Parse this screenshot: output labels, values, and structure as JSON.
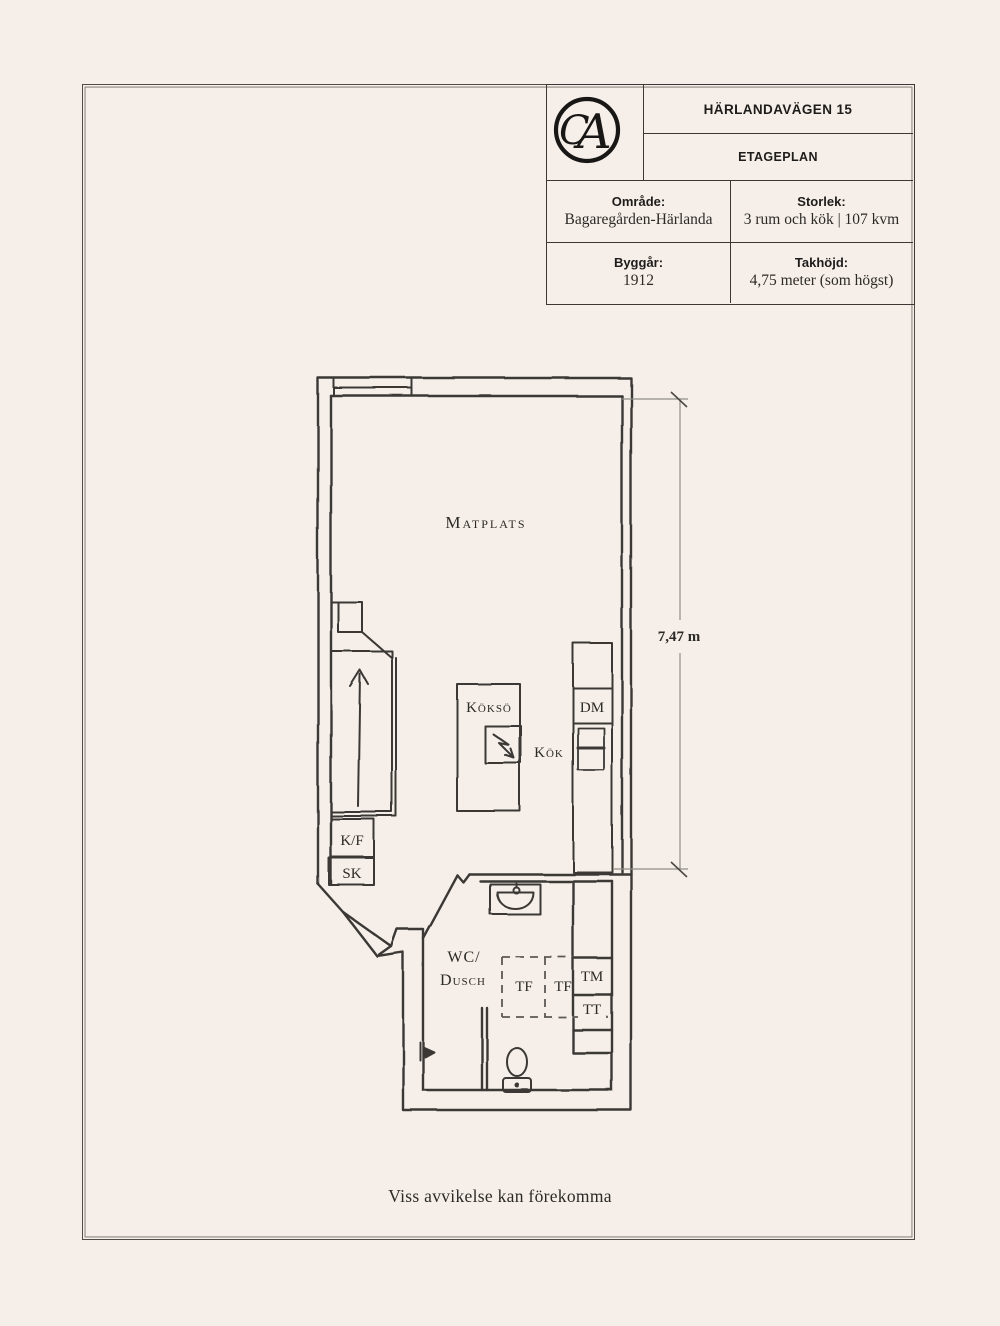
{
  "page": {
    "background": "#f6efe9",
    "frame_color": "#4f4b45",
    "line_color": "#3a3835"
  },
  "header": {
    "logo": {
      "monogram_c": "C",
      "monogram_a": "A"
    },
    "address": "HÄRLANDAVÄGEN 15",
    "plan_type": "ETAGEPLAN",
    "fields": {
      "omrade": {
        "label": "Område:",
        "value": "Bagaregården-Härlanda"
      },
      "storlek": {
        "label": "Storlek:",
        "value": "3 rum och kök | 107 kvm"
      },
      "byggar": {
        "label": "Byggår:",
        "value": "1912"
      },
      "takhojd": {
        "label": "Takhöjd:",
        "value": "4,75 meter (som högst)"
      }
    }
  },
  "floorplan": {
    "rooms": {
      "matplats": "Matplats",
      "koksoe": "Köksö",
      "kok": "Kök",
      "wc_line1": "WC/",
      "wc_line2": "Dusch"
    },
    "fixtures": {
      "kf": "K/F",
      "sk": "SK",
      "dm": "DM",
      "tm": "TM",
      "tt": "TT",
      "tf1": "TF",
      "tf2": "TF"
    },
    "dimension": {
      "label": "7,47 m"
    }
  },
  "footer": {
    "note": "Viss avvikelse kan förekomma"
  }
}
